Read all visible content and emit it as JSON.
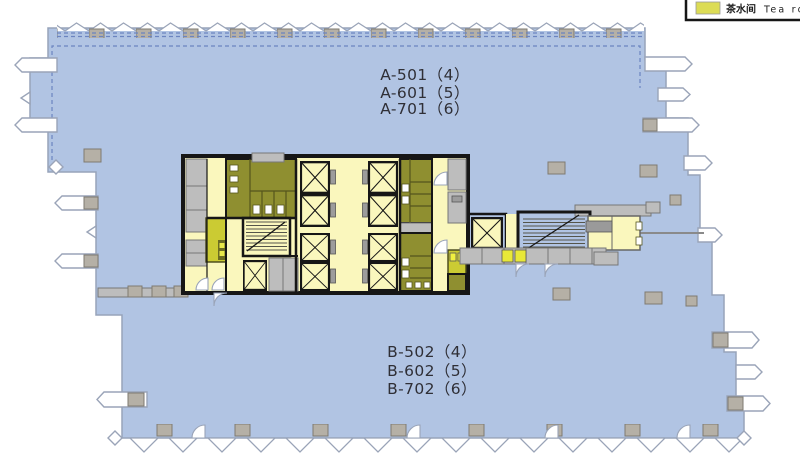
{
  "legend": {
    "items": [
      {
        "swatch_color": "#dcdc55",
        "label_zh": "茶水间",
        "label_en": "Tea ro"
      }
    ]
  },
  "units": {
    "zone_a": [
      "A-501（4）",
      "A-601（5）",
      "A-701（6）"
    ],
    "zone_b": [
      "B-502（4）",
      "B-602（5）",
      "B-702（6）"
    ]
  },
  "colors": {
    "floor_plate": "#b1c4e3",
    "floor_plate_edge": "#97a3ba",
    "core_circulation": "#faf7bd",
    "tea_room": "#cbcb33",
    "restroom": "#8f8f30",
    "service_gray": "#bdbdbd",
    "wall": "#161616",
    "boundary_dash": "#6b84c0"
  }
}
